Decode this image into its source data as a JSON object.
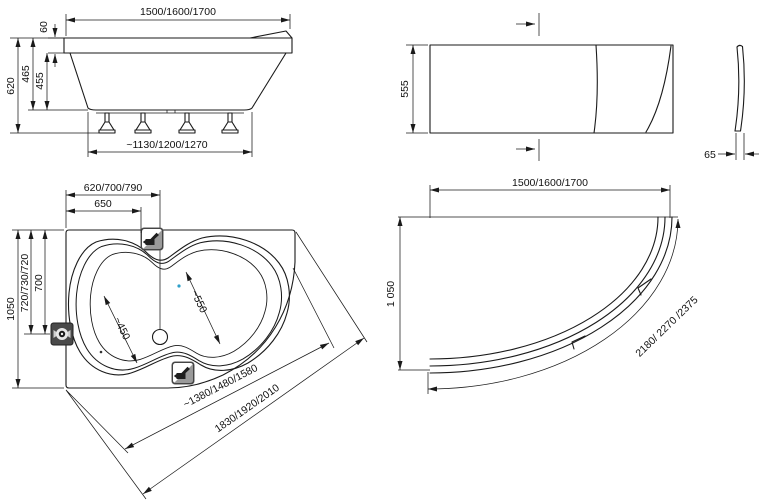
{
  "title": "Corner bathtub technical drawing",
  "views": {
    "side": {
      "length": "1500/1600/1700",
      "rim_height": "60",
      "total_height": "620",
      "depth_to_rim": "465",
      "depth_inner": "455",
      "base_length": "~1130/1200/1270"
    },
    "front_panel": {
      "height": "555",
      "edge_thickness": "65"
    },
    "plan": {
      "width_top": "620/700/790",
      "faucet_offset": "650",
      "height": "1050",
      "overflow_offset": "720/730/720",
      "drain_offset": "700",
      "seat_width": "~450",
      "bath_width": "~550",
      "inner_front_edge": "~1380/1480/1580",
      "outer_front_edge": "1830/1920/2010"
    },
    "apron": {
      "length": "1500/1600/1700",
      "width": "1 050",
      "curve_length": "2180/ 2270 /2375"
    }
  },
  "icons": {
    "faucet": "faucet-icon",
    "overflow": "drain-overflow-icon",
    "drain": "drain-circle"
  },
  "colors": {
    "line": "#1a1a1a",
    "background": "#ffffff",
    "icon_dark": "#4a4a4a",
    "icon_gray": "#9a9a9a",
    "accent_dot": "#2e9fc9"
  }
}
